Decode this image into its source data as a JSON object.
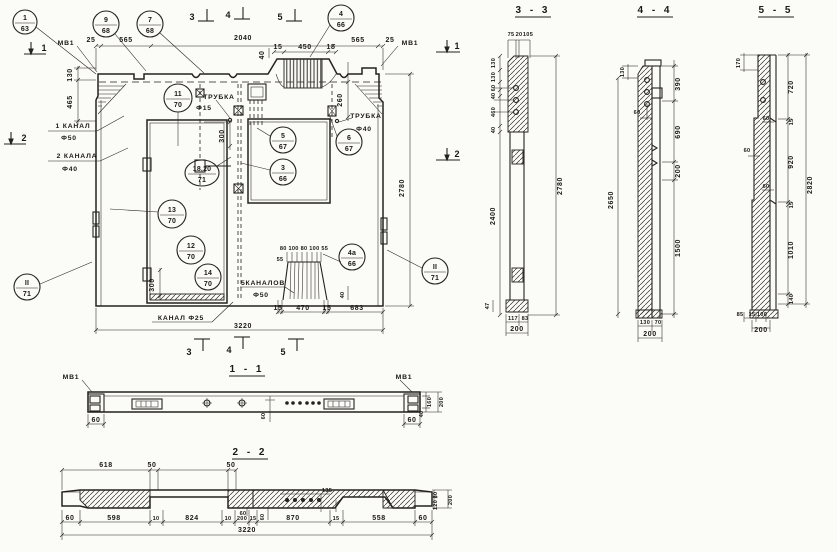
{
  "sheet": {
    "type": "reinforced concrete panel working drawing",
    "ink": "#25221d",
    "paper": "#fbfbf8"
  },
  "main": {
    "mv1_left": "МВ1",
    "mv1_right": "МВ1",
    "marks": {
      "l1": "1",
      "l2": "2",
      "r1": "1",
      "r2": "2",
      "t3": "3",
      "t4": "4",
      "t5": "5",
      "b3": "3",
      "b4": "4",
      "b5": "5"
    },
    "callouts": [
      {
        "num": "1",
        "den": "63"
      },
      {
        "num": "9",
        "den": "68"
      },
      {
        "num": "7",
        "den": "68"
      },
      {
        "num": "4",
        "den": "66"
      },
      {
        "num": "11",
        "den": "70"
      },
      {
        "num": "5",
        "den": "67"
      },
      {
        "num": "6",
        "den": "67"
      },
      {
        "num": "3",
        "den": "66"
      },
      {
        "num": "18,20",
        "den": "71"
      },
      {
        "num": "13",
        "den": "70"
      },
      {
        "num": "12",
        "den": "70"
      },
      {
        "num": "14",
        "den": "70"
      },
      {
        "num": "4а",
        "den": "66"
      },
      {
        "num": "II",
        "den": "71"
      },
      {
        "num": "II",
        "den": "71"
      }
    ],
    "labels": {
      "trubka15_t": "ТРУБКА",
      "trubka15_d": "Ф15",
      "trubka40_t": "ТРУБКА",
      "trubka40_d": "Ф40",
      "kanal1_t": "1 КАНАЛ",
      "kanal1_d": "Ф50",
      "kanal2_t": "2 КАНАЛА",
      "kanal2_d": "Ф40",
      "kanal5_t": "5КАНАЛОВ",
      "kanal5_d": "Ф50",
      "kanal25": "КАНАЛ Ф25"
    },
    "dims": {
      "d25l": "25",
      "d565l": "565",
      "d2040": "2040",
      "d565r": "565",
      "d25r": "25",
      "d15a": "15",
      "d450": "450",
      "d15b": "15",
      "d40t": "40",
      "d130": "130",
      "d465": "465",
      "d300a": "300",
      "d260": "260",
      "d2780": "2780",
      "d300b": "300",
      "fan": "80 100 80 100 55",
      "d55": "55",
      "d15c": "15",
      "d470": "470",
      "d15d": "15",
      "d683": "683",
      "d40b": "40",
      "d3220": "3220"
    }
  },
  "s33": {
    "title": "3 - 3",
    "t1": "75",
    "t2": "20",
    "t3": "105",
    "lstack": [
      "130",
      "130",
      "60",
      "40",
      "460",
      "40"
    ],
    "l2400": "2400",
    "r2780": "2780",
    "b47": "47",
    "b117": "117",
    "b83": "83",
    "b200": "200"
  },
  "s44": {
    "title": "4 - 4",
    "l130": "130",
    "l60": "60",
    "l2650": "2650",
    "r390": "390",
    "r690": "690",
    "r200": "200",
    "r1500": "1500",
    "b130": "130",
    "b70": "70",
    "b200": "200"
  },
  "s55": {
    "title": "5 - 5",
    "t170": "170",
    "l60a": "60",
    "l60b": "60",
    "l60c": "60",
    "r720": "720",
    "r15a": "15",
    "r920": "920",
    "r15b": "15",
    "r1010": "1010",
    "r140": "140",
    "r2820": "2820",
    "b85": "85",
    "b15": "15",
    "b100": "100",
    "b200": "200"
  },
  "s11": {
    "title": "1 - 1",
    "mv1l": "МВ1",
    "mv1r": "МВ1",
    "d60l": "60",
    "d60c": "60",
    "d60r": "60",
    "r160": "160",
    "r200": "200",
    "r40": "40"
  },
  "s22": {
    "title": "2 - 2",
    "t618": "618",
    "t50a": "50",
    "t50b": "50",
    "r80": "80",
    "r120": "120",
    "r200": "200",
    "m60a": "60",
    "m60b": "60",
    "m135": "135",
    "b60l": "60",
    "b598": "598",
    "b10a": "10",
    "b824": "824",
    "b10b": "10",
    "b200": "200",
    "b15a": "15",
    "b870": "870",
    "b15b": "15",
    "b558": "558",
    "b60r": "60",
    "b3220": "3220"
  }
}
